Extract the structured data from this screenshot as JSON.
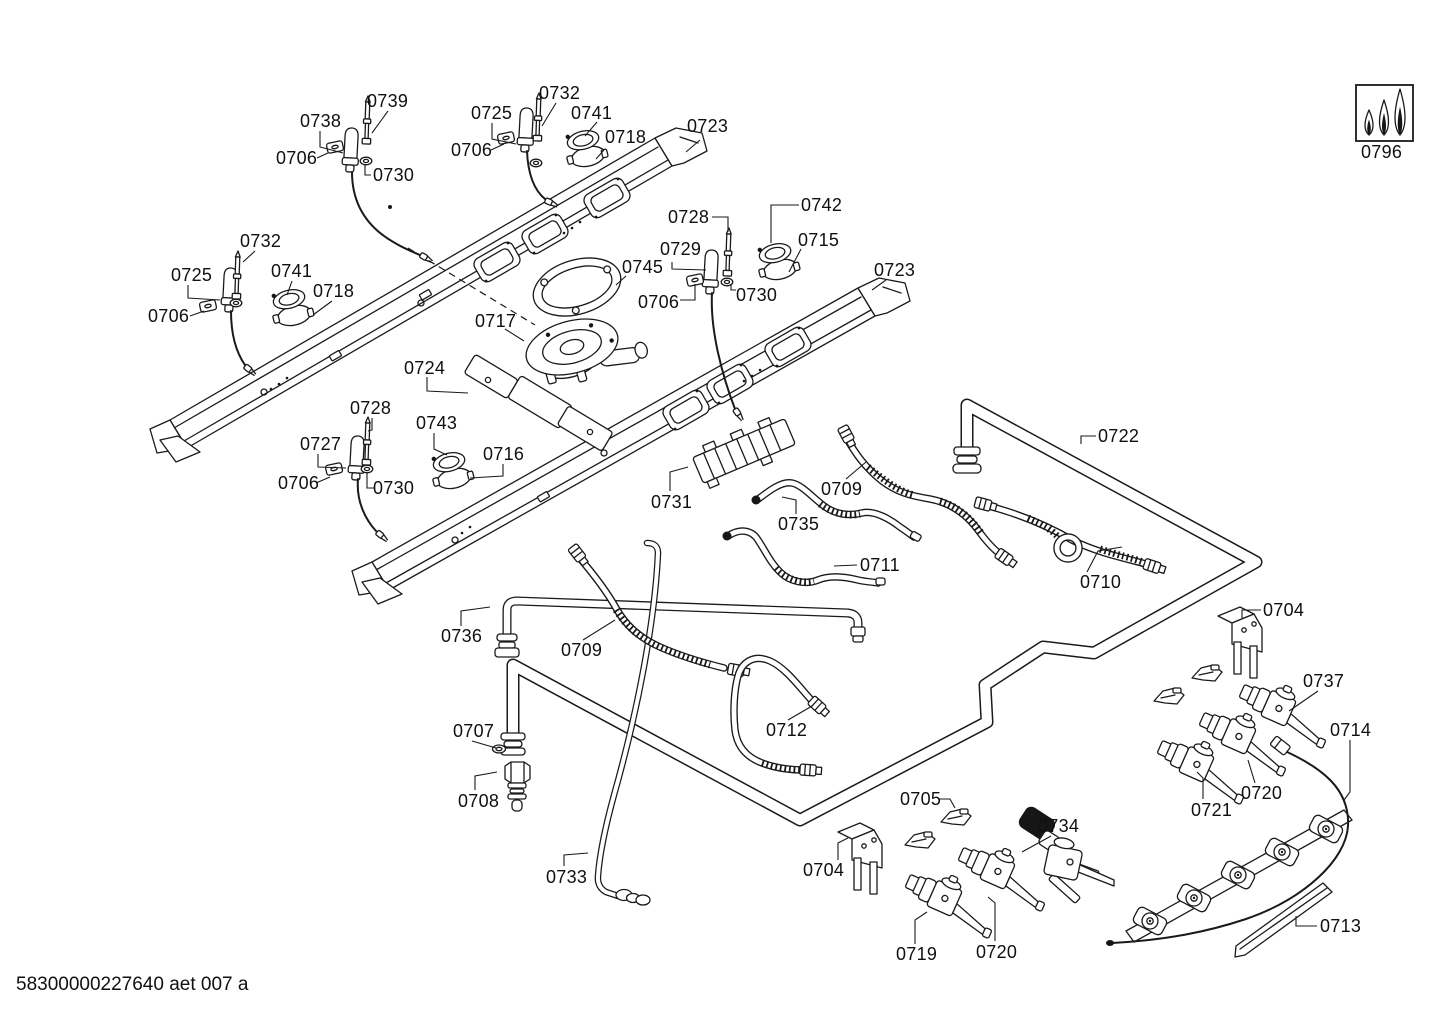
{
  "document": {
    "footer_code": "58300000227640 aet 007 a"
  },
  "diagram": {
    "labels": [
      {
        "text": "0738",
        "x": 300,
        "y": 112,
        "leader": [
          320,
          131,
          320,
          147,
          343,
          153
        ]
      },
      {
        "text": "0739",
        "x": 367,
        "y": 92,
        "leader": [
          388,
          111,
          372,
          133
        ]
      },
      {
        "text": "0732",
        "x": 539,
        "y": 84,
        "leader": [
          556,
          103,
          542,
          126
        ]
      },
      {
        "text": "0725",
        "x": 471,
        "y": 104,
        "leader": [
          492,
          123,
          492,
          139,
          516,
          144
        ]
      },
      {
        "text": "0741",
        "x": 571,
        "y": 104,
        "leader": [
          597,
          122,
          585,
          136
        ]
      },
      {
        "text": "0718",
        "x": 605,
        "y": 128,
        "leader": [
          604,
          150,
          596,
          159
        ]
      },
      {
        "text": "0723",
        "x": 687,
        "y": 117,
        "leader": [
          700,
          140,
          686,
          152
        ]
      },
      {
        "text": "0706",
        "x": 276,
        "y": 149,
        "leader": [
          317,
          158,
          328,
          153
        ]
      },
      {
        "text": "0706",
        "x": 451,
        "y": 141,
        "leader": [
          491,
          150,
          504,
          144
        ]
      },
      {
        "text": "0730",
        "x": 373,
        "y": 166,
        "leader": [
          371,
          175,
          365,
          175,
          365,
          165
        ]
      },
      {
        "text": "0728",
        "x": 668,
        "y": 208,
        "leader": [
          712,
          217,
          728,
          217,
          728,
          232
        ]
      },
      {
        "text": "0742",
        "x": 801,
        "y": 196,
        "leader": [
          799,
          205,
          771,
          205,
          771,
          243
        ]
      },
      {
        "text": "0729",
        "x": 660,
        "y": 240,
        "leader": [
          672,
          262,
          672,
          269,
          706,
          270
        ]
      },
      {
        "text": "0715",
        "x": 798,
        "y": 231,
        "leader": [
          801,
          249,
          789,
          272
        ]
      },
      {
        "text": "0745",
        "x": 622,
        "y": 258,
        "leader": [
          626,
          276,
          616,
          285
        ]
      },
      {
        "text": "0732",
        "x": 240,
        "y": 232,
        "leader": [
          255,
          251,
          243,
          262
        ]
      },
      {
        "text": "0725",
        "x": 171,
        "y": 266,
        "leader": [
          188,
          285,
          188,
          298,
          220,
          300
        ]
      },
      {
        "text": "0741",
        "x": 271,
        "y": 262,
        "leader": [
          292,
          281,
          287,
          295
        ]
      },
      {
        "text": "0718",
        "x": 313,
        "y": 282,
        "leader": [
          332,
          301,
          313,
          315
        ]
      },
      {
        "text": "0706",
        "x": 148,
        "y": 307,
        "leader": [
          190,
          316,
          204,
          311
        ]
      },
      {
        "text": "0706",
        "x": 638,
        "y": 293,
        "leader": [
          680,
          300,
          695,
          300,
          695,
          284
        ]
      },
      {
        "text": "0730",
        "x": 736,
        "y": 286,
        "leader": [
          736,
          290,
          731,
          290,
          731,
          284
        ]
      },
      {
        "text": "0723",
        "x": 874,
        "y": 261,
        "leader": [
          886,
          280,
          872,
          290
        ]
      },
      {
        "text": "0717",
        "x": 475,
        "y": 312,
        "leader": [
          505,
          329,
          524,
          341
        ]
      },
      {
        "text": "0724",
        "x": 404,
        "y": 359,
        "leader": [
          427,
          377,
          427,
          391,
          468,
          393
        ]
      },
      {
        "text": "0728",
        "x": 350,
        "y": 399,
        "leader": [
          372,
          418,
          372,
          430,
          368,
          431
        ]
      },
      {
        "text": "0743",
        "x": 416,
        "y": 414,
        "leader": [
          434,
          433,
          434,
          449,
          447,
          455
        ]
      },
      {
        "text": "0727",
        "x": 300,
        "y": 435,
        "leader": [
          318,
          454,
          318,
          467,
          346,
          468
        ]
      },
      {
        "text": "0716",
        "x": 483,
        "y": 445,
        "leader": [
          503,
          464,
          503,
          476,
          470,
          478
        ]
      },
      {
        "text": "0706",
        "x": 278,
        "y": 474,
        "leader": [
          316,
          483,
          330,
          477
        ]
      },
      {
        "text": "0730",
        "x": 373,
        "y": 479,
        "leader": [
          375,
          488,
          367,
          488,
          367,
          472
        ]
      },
      {
        "text": "0722",
        "x": 1098,
        "y": 427,
        "leader": [
          1096,
          436,
          1081,
          436,
          1081,
          444
        ]
      },
      {
        "text": "0731",
        "x": 651,
        "y": 493,
        "leader": [
          670,
          491,
          670,
          472,
          688,
          467
        ]
      },
      {
        "text": "0709",
        "x": 821,
        "y": 480,
        "leader": [
          846,
          479,
          866,
          462
        ]
      },
      {
        "text": "0735",
        "x": 778,
        "y": 515,
        "leader": [
          796,
          514,
          796,
          500,
          782,
          497
        ]
      },
      {
        "text": "0711",
        "x": 860,
        "y": 556,
        "leader": [
          857,
          565,
          834,
          566
        ]
      },
      {
        "text": "0710",
        "x": 1080,
        "y": 573,
        "leader": [
          1087,
          572,
          1098,
          551,
          1122,
          547
        ]
      },
      {
        "text": "0704",
        "x": 1263,
        "y": 601,
        "leader": [
          1261,
          610,
          1242,
          610,
          1242,
          618
        ]
      },
      {
        "text": "0736",
        "x": 441,
        "y": 627,
        "leader": [
          461,
          626,
          461,
          611,
          490,
          607
        ]
      },
      {
        "text": "0709",
        "x": 561,
        "y": 641,
        "leader": [
          583,
          640,
          615,
          620
        ]
      },
      {
        "text": "0737",
        "x": 1303,
        "y": 672,
        "leader": [
          1318,
          691,
          1289,
          711
        ]
      },
      {
        "text": "0714",
        "x": 1330,
        "y": 721,
        "leader": [
          1350,
          740,
          1350,
          792,
          1344,
          800
        ]
      },
      {
        "text": "0712",
        "x": 766,
        "y": 721,
        "leader": [
          788,
          720,
          812,
          706
        ]
      },
      {
        "text": "0707",
        "x": 453,
        "y": 722,
        "leader": [
          472,
          741,
          496,
          748
        ]
      },
      {
        "text": "0705",
        "x": 900,
        "y": 790,
        "leader": [
          939,
          799,
          950,
          799,
          955,
          808
        ]
      },
      {
        "text": "0720",
        "x": 1241,
        "y": 784,
        "leader": [
          1255,
          783,
          1248,
          760
        ]
      },
      {
        "text": "0708",
        "x": 458,
        "y": 792,
        "leader": [
          475,
          790,
          475,
          776,
          497,
          772
        ]
      },
      {
        "text": "0721",
        "x": 1191,
        "y": 801,
        "leader": [
          1203,
          799,
          1203,
          778,
          1197,
          772
        ]
      },
      {
        "text": "0734",
        "x": 1038,
        "y": 817,
        "leader": [
          1051,
          836,
          1022,
          852
        ]
      },
      {
        "text": "0704",
        "x": 803,
        "y": 861,
        "leader": [
          838,
          860,
          838,
          843,
          848,
          838
        ]
      },
      {
        "text": "0733",
        "x": 546,
        "y": 868,
        "leader": [
          564,
          866,
          564,
          855,
          588,
          853
        ]
      },
      {
        "text": "0719",
        "x": 896,
        "y": 945,
        "leader": [
          915,
          944,
          915,
          920,
          927,
          912
        ]
      },
      {
        "text": "0720",
        "x": 976,
        "y": 943,
        "leader": [
          995,
          941,
          995,
          903,
          988,
          897
        ]
      },
      {
        "text": "0713",
        "x": 1320,
        "y": 917,
        "leader": [
          1317,
          926,
          1296,
          926,
          1296,
          916
        ]
      },
      {
        "text": "0796",
        "x": 1361,
        "y": 143,
        "leader": []
      }
    ]
  }
}
